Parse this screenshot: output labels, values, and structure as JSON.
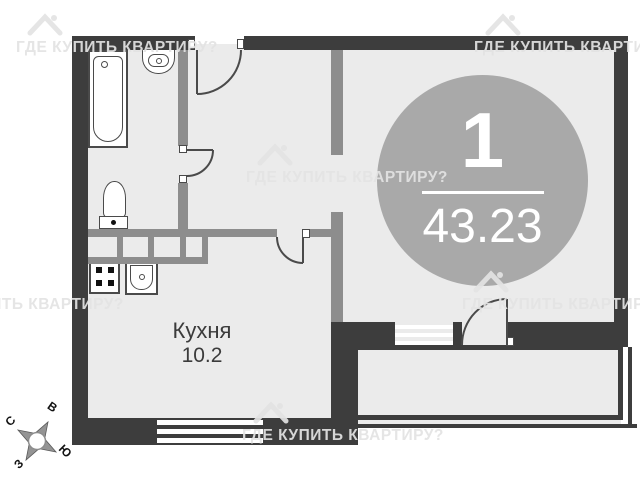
{
  "badge": {
    "number": "1",
    "area": "43.23"
  },
  "rooms": {
    "kitchen": {
      "name": "Кухня",
      "area": "10.2"
    }
  },
  "compass": {
    "north": "С",
    "east": "В",
    "south": "Ю",
    "west": "З"
  },
  "watermark": {
    "text": "ГДЕ КУПИТЬ КВАРТИРУ?"
  },
  "colors": {
    "wall": "#3d3d3d",
    "partition": "#8d8d8d",
    "floor": "#ebebeb",
    "circle": "#a9a9a9",
    "fixture": "#4a4a4a",
    "ink": "#3b3b3b",
    "wm": "#e3e3e3"
  }
}
